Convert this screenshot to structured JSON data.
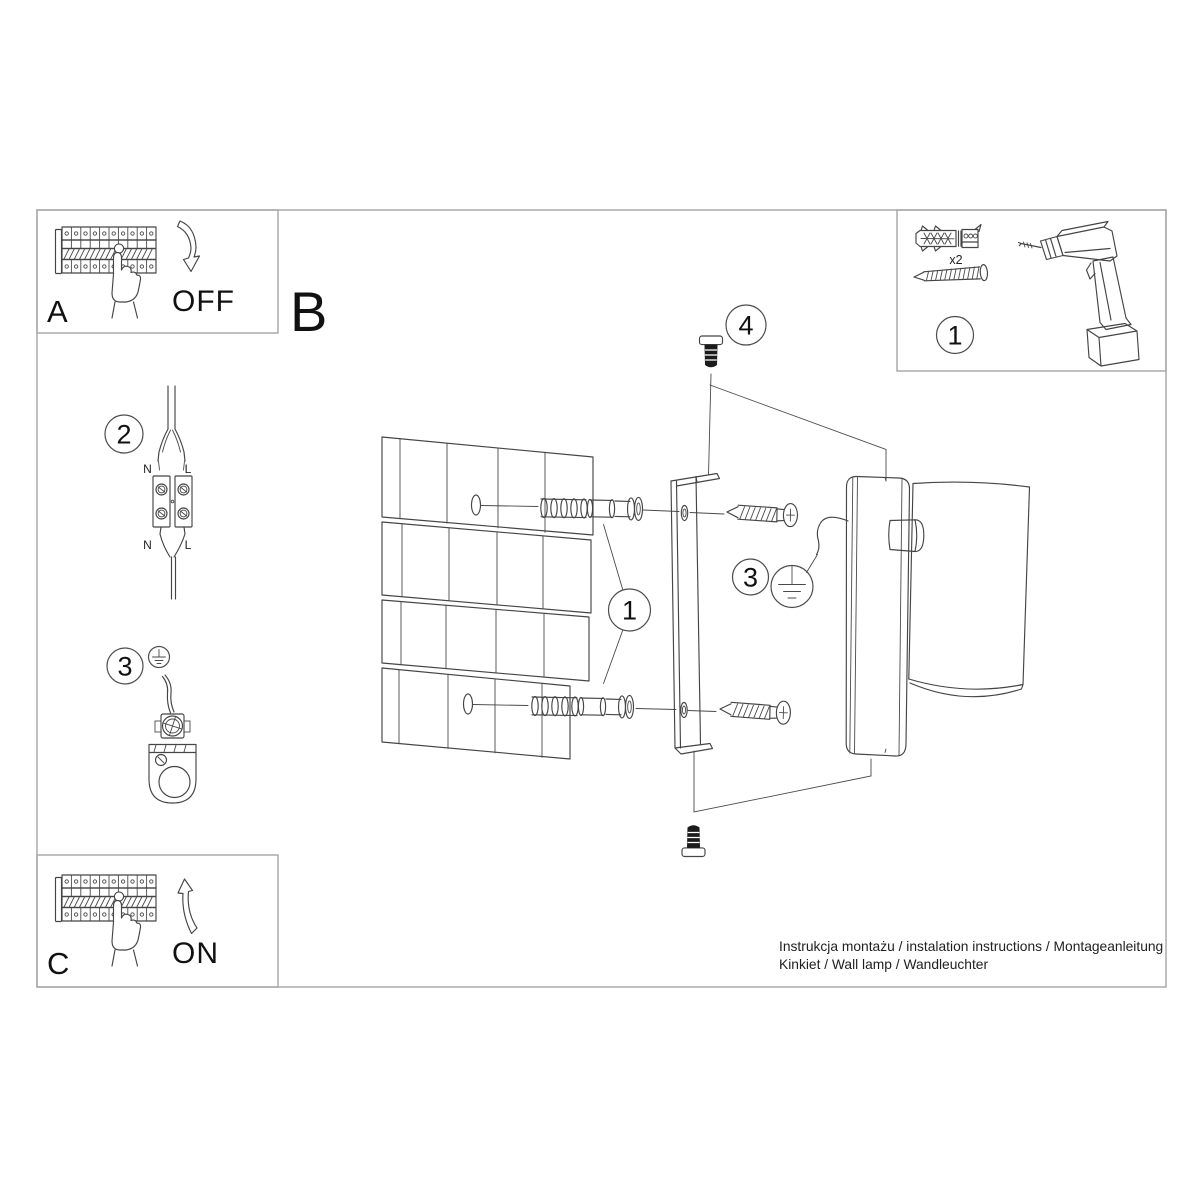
{
  "panel": {
    "label_b": "B",
    "step_a": {
      "label": "A",
      "switch_state": "OFF"
    },
    "step_c": {
      "label": "C",
      "switch_state": "ON"
    },
    "tools": {
      "callout": "1",
      "anchor_quantity": "x2"
    },
    "wiring": {
      "callout": "2",
      "n_top": "N",
      "l_top": "L",
      "n_bottom": "N",
      "l_bottom": "L"
    },
    "ground_left": {
      "callout": "3"
    },
    "exploded": {
      "anchors_callout": "1",
      "ground_callout": "3",
      "screw_callout": "4"
    },
    "footer": {
      "line1": "Instrukcja montażu / instalation instructions / Montageanleitung",
      "line2": "Kinkiet / Wall lamp / Wandleuchter"
    }
  },
  "colors": {
    "line": "#454545",
    "frame": "#a5a5a5",
    "ink": "#111111",
    "screw_fill": "#1b1b1b"
  }
}
